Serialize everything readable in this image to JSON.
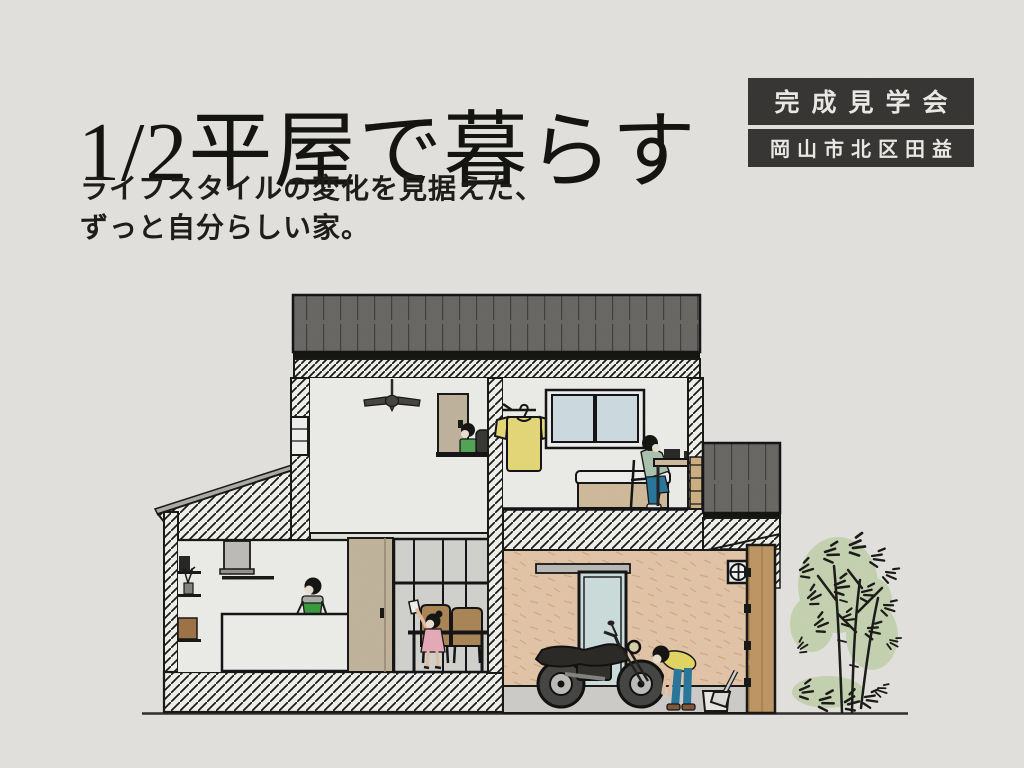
{
  "page": {
    "width": 1024,
    "height": 768,
    "background_color": "#edece8"
  },
  "poster": {
    "title": "1/2平屋で暮らす",
    "subtitle": {
      "line1": "ライフスタイルの変化を見据えた、",
      "line2": "ずっと自分らしい家。"
    },
    "event_badge": {
      "event_name": "完成見学会",
      "location": "岡山市北区田益",
      "background_color": "#3b3a38",
      "text_color": "#f6f5f2"
    },
    "colors": {
      "text": "#161614",
      "roof_gray": "#6f6e6a",
      "hatch_ink": "#1b1b19",
      "garage_wall_peach": "#edcfb0",
      "wood_gate": "#c79e6a",
      "sliding_door_tan": "#cbbda4",
      "window_glass_blue": "#d7e5eb",
      "partition_glass_gray": "#dbdbd7",
      "foliage_green": "#cadbb3",
      "apron_green": "#3fa246",
      "tshirt_yellow": "#efe27f",
      "dress_pink": "#f2b3c2",
      "jeans_blue": "#2d7ca3"
    },
    "illustration_elements": [
      "house-cross-section",
      "metal-roof",
      "ceiling-fan",
      "loft-boy",
      "hanging-tshirt",
      "bedroom-window",
      "bed",
      "desk-person",
      "kitchen-mom",
      "kitchen-island",
      "wall-shelves",
      "glass-partition",
      "dining-girl",
      "dining-table",
      "garage",
      "motorcycle",
      "bending-man",
      "bucket",
      "dustpan",
      "round-vent",
      "wooden-gate",
      "tree"
    ]
  }
}
